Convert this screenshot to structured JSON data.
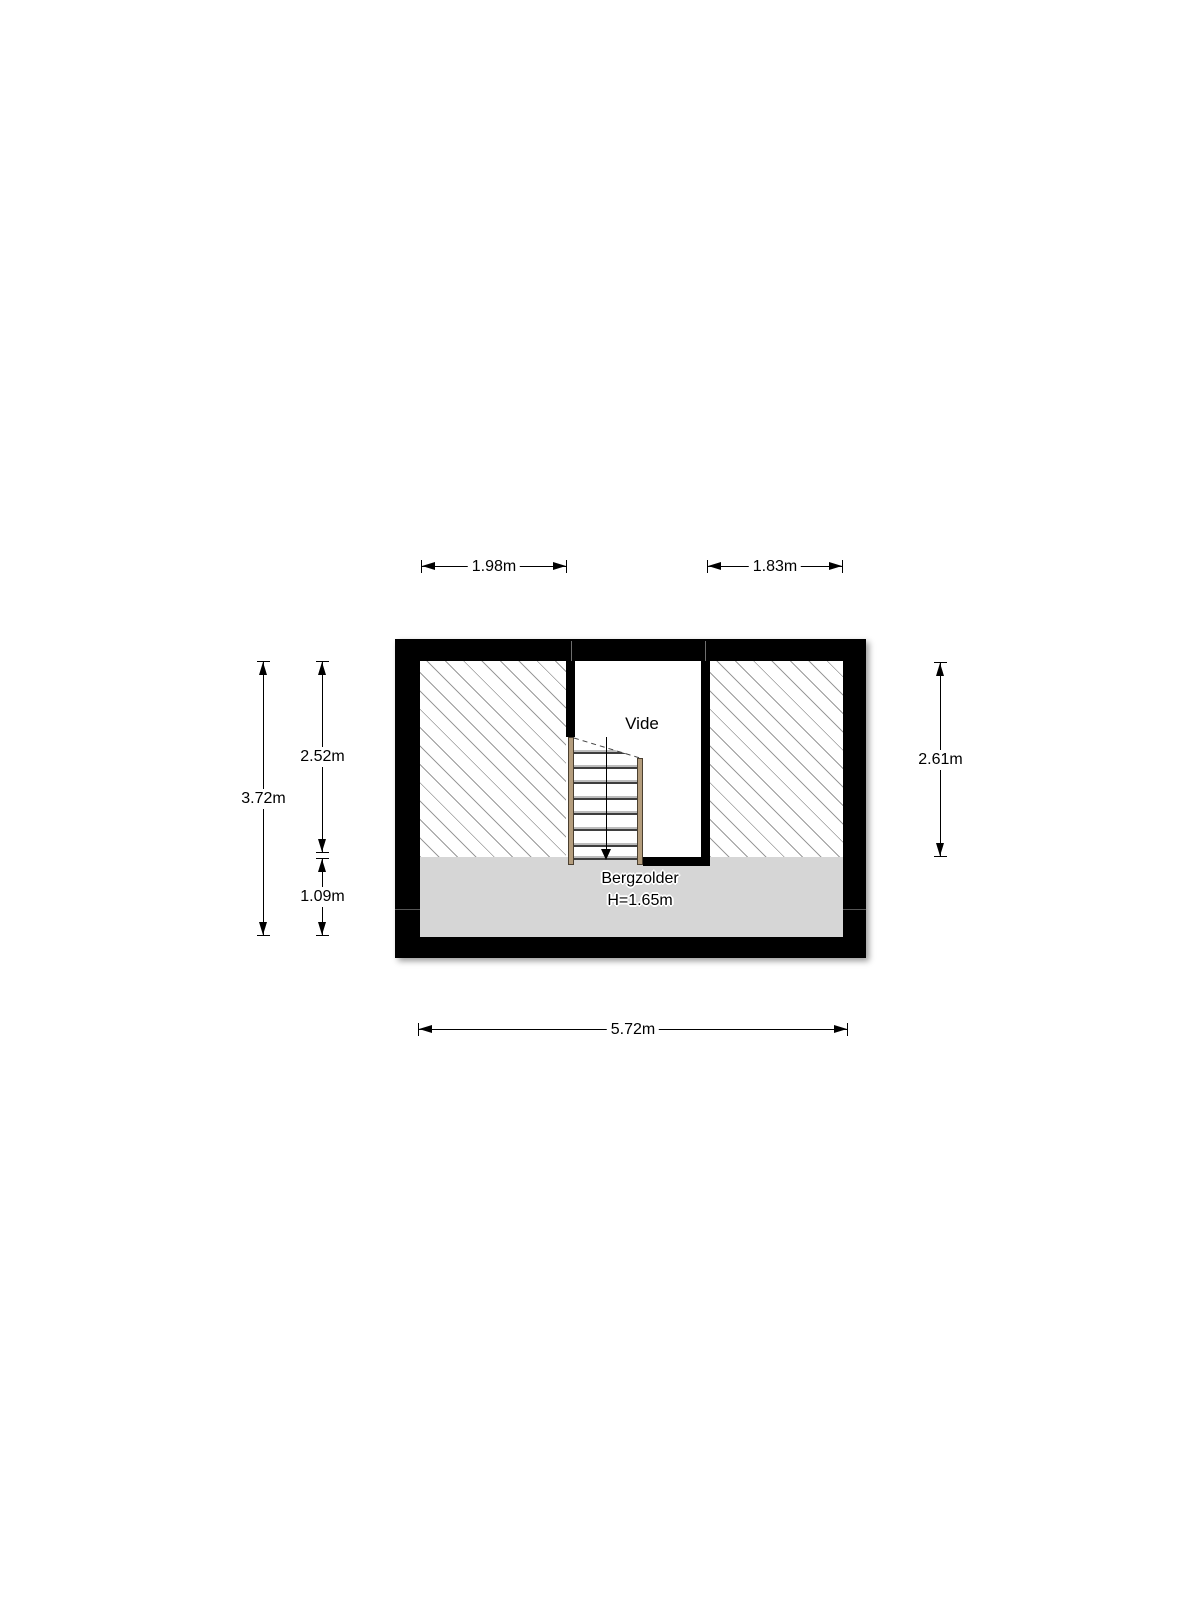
{
  "canvas": {
    "width": 1200,
    "height": 1600,
    "background": "#ffffff"
  },
  "floorplan": {
    "type": "attic-floor-plan",
    "labels": {
      "void": "Vide",
      "room": "Bergzolder",
      "room_height": "H=1.65m"
    },
    "dimensions": {
      "top_left": "1.98m",
      "top_right": "1.83m",
      "left_total": "3.72m",
      "left_upper": "2.52m",
      "left_lower": "1.09m",
      "right": "2.61m",
      "bottom": "5.72m"
    },
    "colors": {
      "wall": "#000000",
      "floor_gray": "#d6d6d6",
      "hatch_line": "#9a9a9a",
      "stair_wood": "#b49d7d",
      "stair_wood_edge": "#4a3f30",
      "dimension": "#000000",
      "background": "#ffffff"
    },
    "stairs": {
      "tread_count": 8,
      "direction_arrow": "down"
    }
  }
}
